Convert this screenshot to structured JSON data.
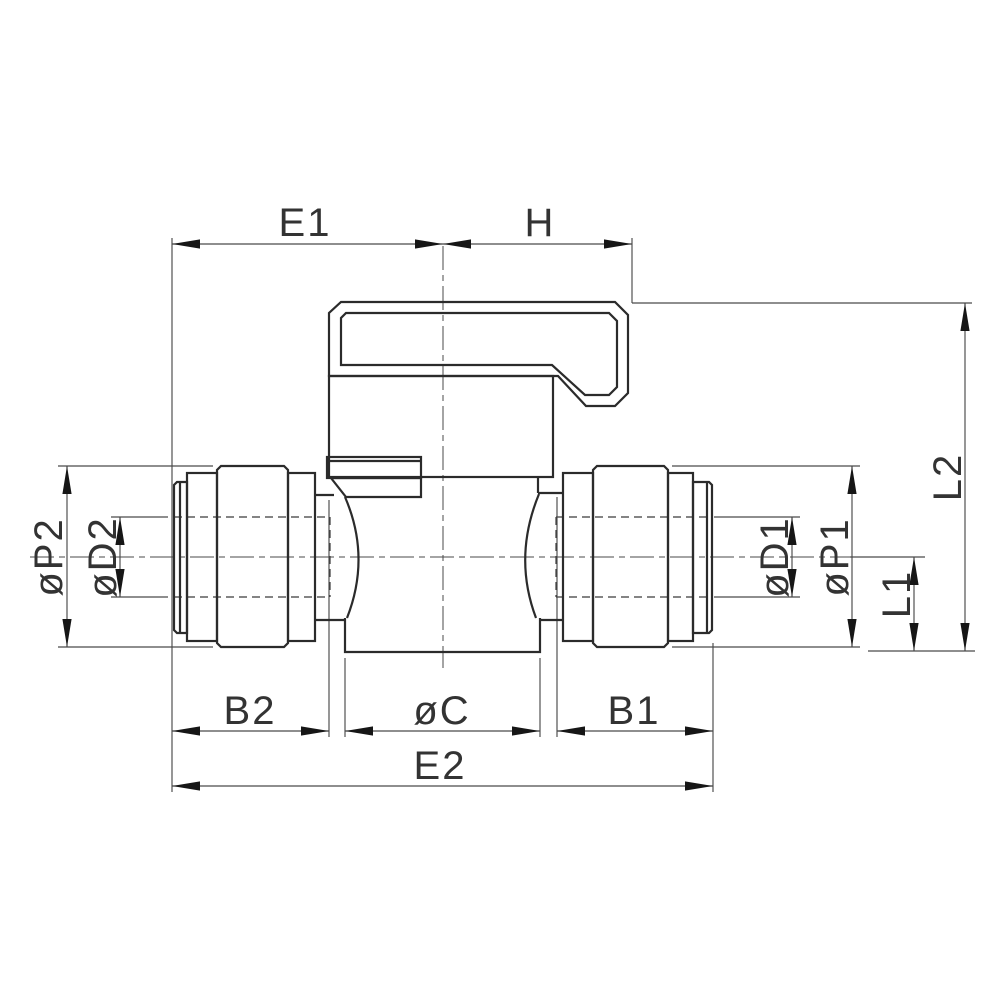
{
  "drawing": {
    "kind": "technical-dimension-drawing",
    "subject": "mini ball valve with push-fit connectors, side elevation",
    "colors": {
      "background": "#ffffff",
      "object_line": "#2b2b2b",
      "dimension_line": "#4a4a4a",
      "hidden_line": "#3a3a3a",
      "arrow_fill": "#161616",
      "text": "#333333"
    },
    "labels": {
      "e1": "E1",
      "h": "H",
      "l2": "L2",
      "l1": "L1",
      "p2": "øP2",
      "d2": "øD2",
      "d1": "øD1",
      "p1": "øP1",
      "b2": "B2",
      "c": "øC",
      "b1": "B1",
      "e2": "E2"
    }
  }
}
